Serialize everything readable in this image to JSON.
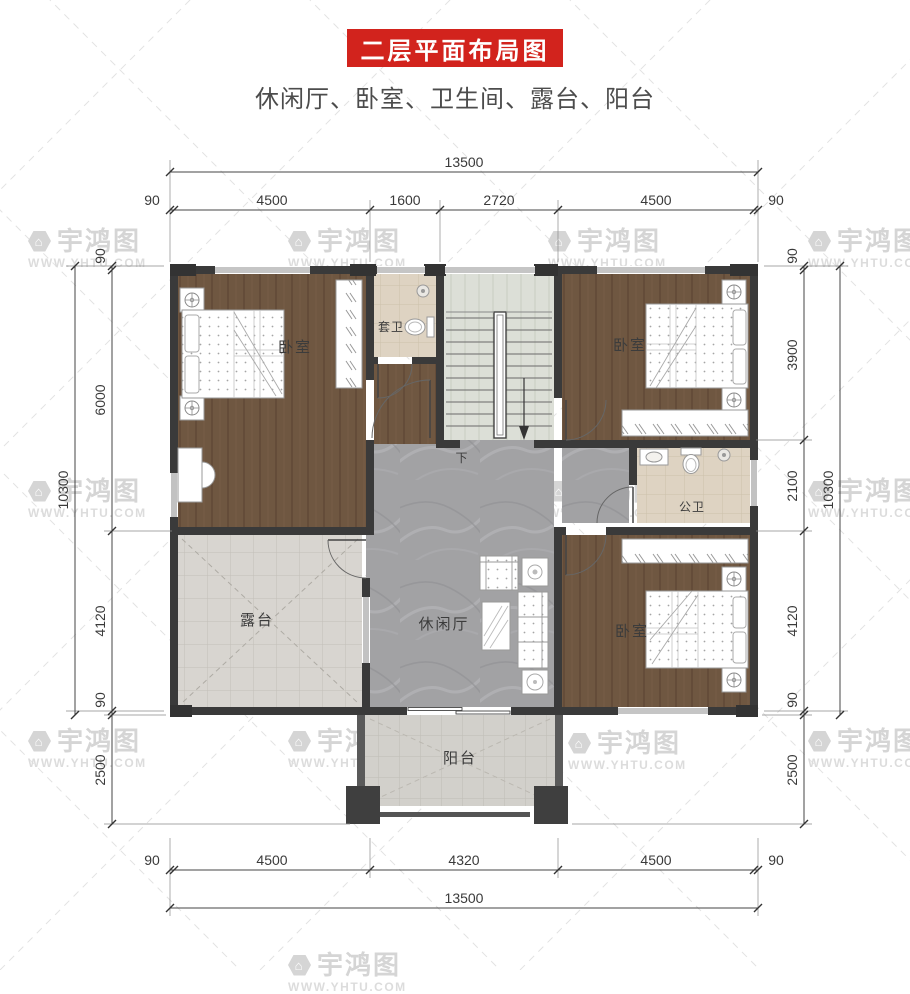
{
  "title": "二层平面布局图",
  "subtitle": "休闲厅、卧室、卫生间、露台、阳台",
  "watermark": {
    "brand": "宇鸿图",
    "site": "WWW.YHTU.COM"
  },
  "rooms": {
    "bedroom_left": "卧室",
    "bedroom_top_right": "卧室",
    "bedroom_bottom_right": "卧室",
    "ensuite_bath": "套卫",
    "public_bath": "公卫",
    "terrace": "露台",
    "leisure_hall": "休闲厅",
    "balcony": "阳台",
    "stairs_down": "下"
  },
  "dimensions": {
    "top": {
      "total": "13500",
      "segments": [
        "90",
        "4500",
        "1600",
        "2720",
        "4500",
        "90"
      ]
    },
    "bottom": {
      "total": "13500",
      "segments": [
        "90",
        "4500",
        "4320",
        "4500",
        "90"
      ]
    },
    "left": {
      "total": "10300",
      "segments": [
        "90",
        "6000",
        "4120",
        "90",
        "2500"
      ]
    },
    "right": {
      "total": "10300",
      "segments": [
        "90",
        "3900",
        "2100",
        "4120",
        "90",
        "2500"
      ]
    }
  },
  "colors": {
    "banner_red": "#d2231d",
    "wall": "#3a3a3a",
    "wood_floor": "#6f5741",
    "marble_floor": "#a2a2a4",
    "terrace_tile": "#d8d5d0",
    "bath_tile": "#ded3c2",
    "stair_floor": "#dcdfd7"
  }
}
